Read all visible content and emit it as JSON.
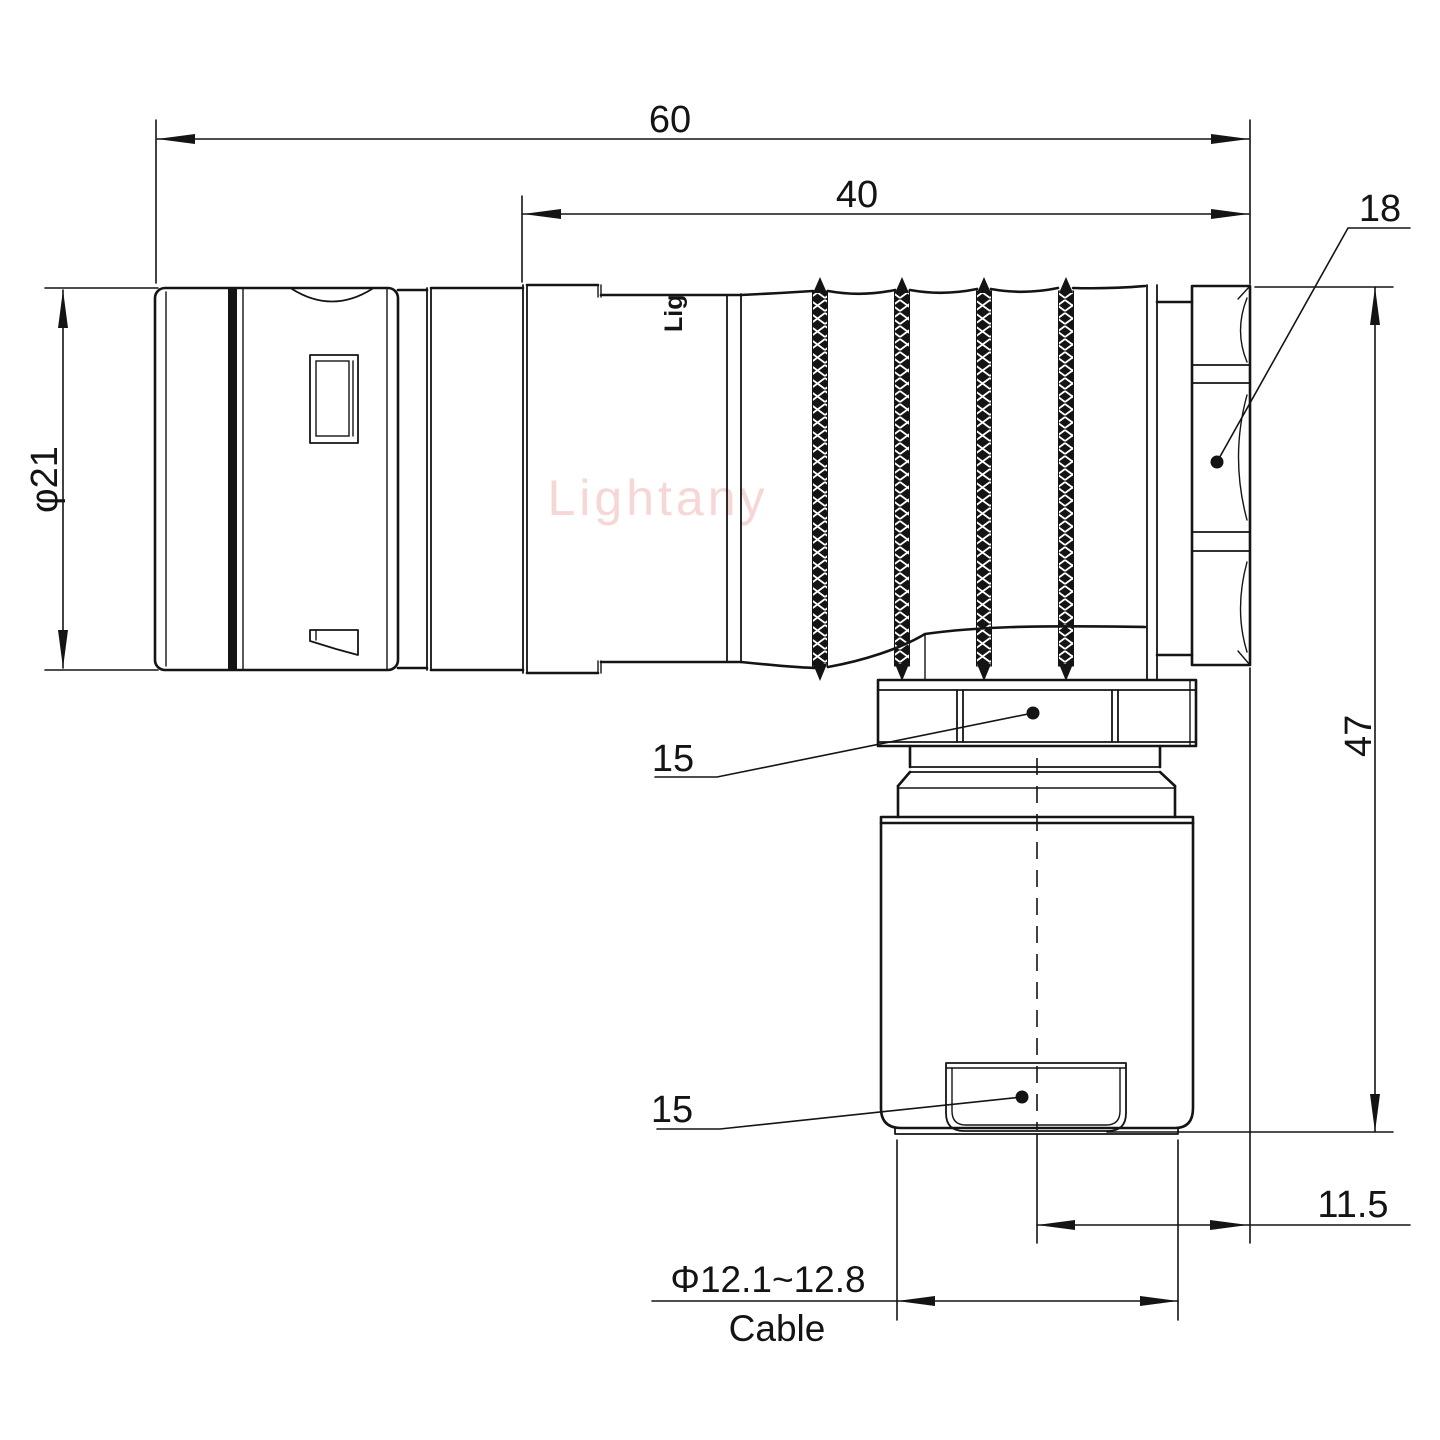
{
  "drawing": {
    "type": "technical-drawing",
    "subject": "right-angle circular push-pull connector, side view with dimensions",
    "branding": {
      "watermark": "Lightany",
      "body_mark": "Lig"
    },
    "colors": {
      "line": "#141414",
      "watermark": "#f6d7d6",
      "background": "#ffffff"
    },
    "dims": {
      "overall_length": "60",
      "backshell_length": "40",
      "nut_across_flats": "18",
      "sleeve_diameter": "φ21",
      "height": "47",
      "elbow_nut": "15",
      "cable_clamp": "15",
      "axis_offset": "11.5",
      "cable_range": "Φ12.1~12.8",
      "cable_label": "Cable"
    }
  }
}
